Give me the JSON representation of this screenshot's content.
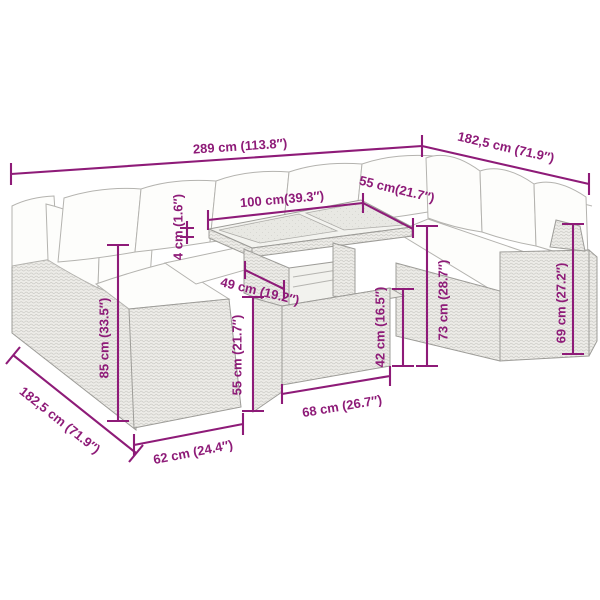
{
  "diagram_type": "furniture-dimension-diagram",
  "product": "garden-lounge-set-with-table",
  "colors": {
    "dimension": "#8E1B78",
    "furniture_line": "#9d9c98",
    "background": "#ffffff"
  },
  "dim": {
    "overall_width": "289 cm (113.8″)",
    "right_wing_depth": "182,5 cm (71.9″)",
    "table_length": "100 cm(39.3″)",
    "table_width": "55 cm(21.7″)",
    "tabletop_thickness": "4 cm (1.6″)",
    "table_base_depth": "49 cm (19.2″)",
    "stool_height": "55 cm (21.7″)",
    "ottoman_height": "42 cm (16.5″)",
    "seat_height": "73 cm (28.7″)",
    "armrest_height": "69 cm (27.2″)",
    "backrest_height": "85 cm (33.5″)",
    "left_wing_depth": "182,5 cm (71.9″)",
    "module_width": "62 cm (24.4″)",
    "ottoman_width": "68 cm (26.7″)"
  }
}
